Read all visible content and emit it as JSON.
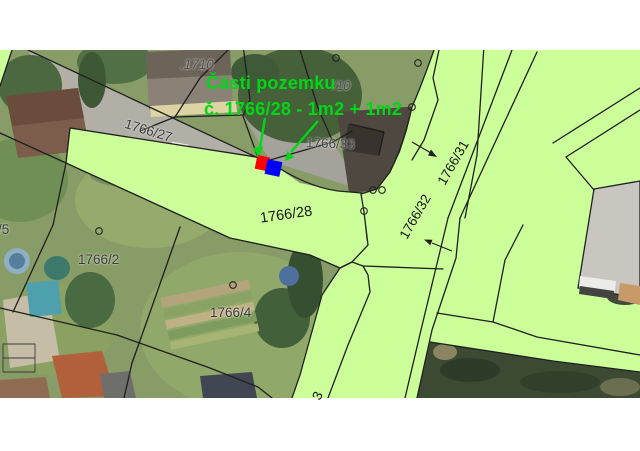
{
  "annotation": {
    "line1": "Části pozemku",
    "line2": "č. 1766/28 - 1m2 + 1m2"
  },
  "parcel_labels": [
    {
      "name": "building-1710",
      "text": ".1710"
    },
    {
      "name": "parcel-10",
      "text": "/10"
    },
    {
      "name": "parcel-1766-33",
      "text": "1766/33"
    },
    {
      "name": "parcel-1766-27",
      "text": "1766/27"
    },
    {
      "name": "parcel-1766-28",
      "text": "1766/28"
    },
    {
      "name": "parcel-1766-2",
      "text": "1766/2"
    },
    {
      "name": "parcel-1766-4",
      "text": "1766/4"
    },
    {
      "name": "parcel-1766-31",
      "text": "1766/31"
    },
    {
      "name": "parcel-1766-32",
      "text": "1766/32"
    },
    {
      "name": "parcel-5",
      "text": "/5"
    },
    {
      "name": "parcel-fragment-3",
      "text": "3"
    }
  ],
  "highlights": {
    "red_square_color": "#ff0000",
    "blue_square_color": "#0000ff",
    "annotation_color": "#00d816"
  },
  "colors": {
    "parcel_fill": "#ccff99",
    "boundary_line": "#1f1f1f",
    "background": "#ffffff"
  }
}
